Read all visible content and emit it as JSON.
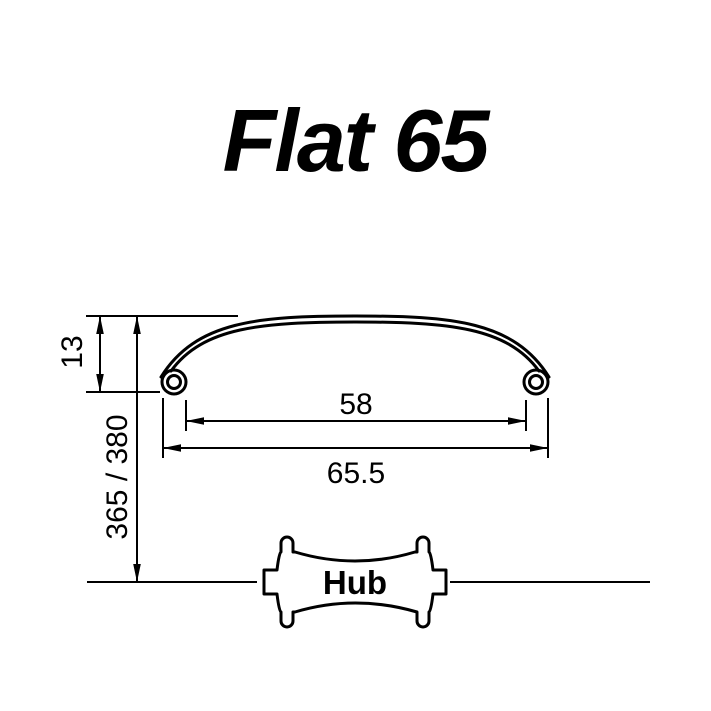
{
  "title": "Flat 65",
  "colors": {
    "ink": "#000000",
    "background": "#ffffff"
  },
  "rim_profile": {
    "description": "flat single-wall rim cross-section with rolled edges",
    "dimensions": {
      "depth": "13",
      "inner_width": "58",
      "outer_width": "65.5",
      "radius_to_hub": "365 / 380"
    }
  },
  "hub": {
    "label": "Hub"
  }
}
